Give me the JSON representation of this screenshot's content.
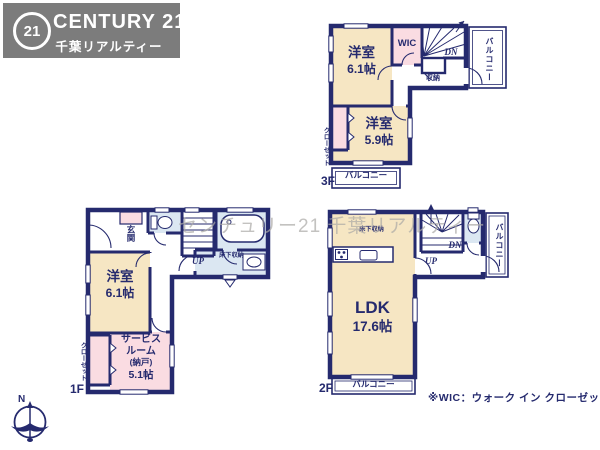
{
  "logo": {
    "seal": "21",
    "title": "CENTURY 21",
    "subtitle": "千葉リアルティー"
  },
  "watermark": "センチュリー21 千葉リアルティー",
  "note": "※WIC：ウォーク イン クローゼット",
  "compass": {
    "north": "N"
  },
  "colors": {
    "wall_navy": "#252a6e",
    "room_cream": "#f6e6c3",
    "closet_pink": "#fadce2",
    "wet_area_blue": "#dbe7f2",
    "logo_gray": "#7c7c7c",
    "watermark_gray": "#aba9a6"
  },
  "floor3": {
    "floor_label": "3F",
    "bedroom1_name": "洋室",
    "bedroom1_size": "6.1帖",
    "bedroom2_name": "洋室",
    "bedroom2_size": "5.9帖",
    "wic_label": "WIC",
    "storage_label": "収納",
    "down_label": "DN",
    "closet_label": "クローゼット",
    "balcony_right_label": "バルコニー",
    "balcony_bottom_label": "バルコニー"
  },
  "floor2": {
    "floor_label": "2F",
    "ldk_name": "LDK",
    "ldk_size": "17.6帖",
    "floor_storage_label": "床下収納",
    "up_label": "UP",
    "down_label": "DN",
    "balcony_right_label": "バルコニー",
    "balcony_bottom_label": "バルコニー"
  },
  "floor1": {
    "floor_label": "1F",
    "entrance_label": "玄関",
    "bedroom_name": "洋室",
    "bedroom_size": "6.1帖",
    "service_line1": "サービス",
    "service_line2": "ルーム",
    "service_line3": "(納戸)",
    "service_line4": "5.1帖",
    "closet_label": "クローゼット",
    "floor_storage_label": "床下収納",
    "up_label": "UP"
  }
}
